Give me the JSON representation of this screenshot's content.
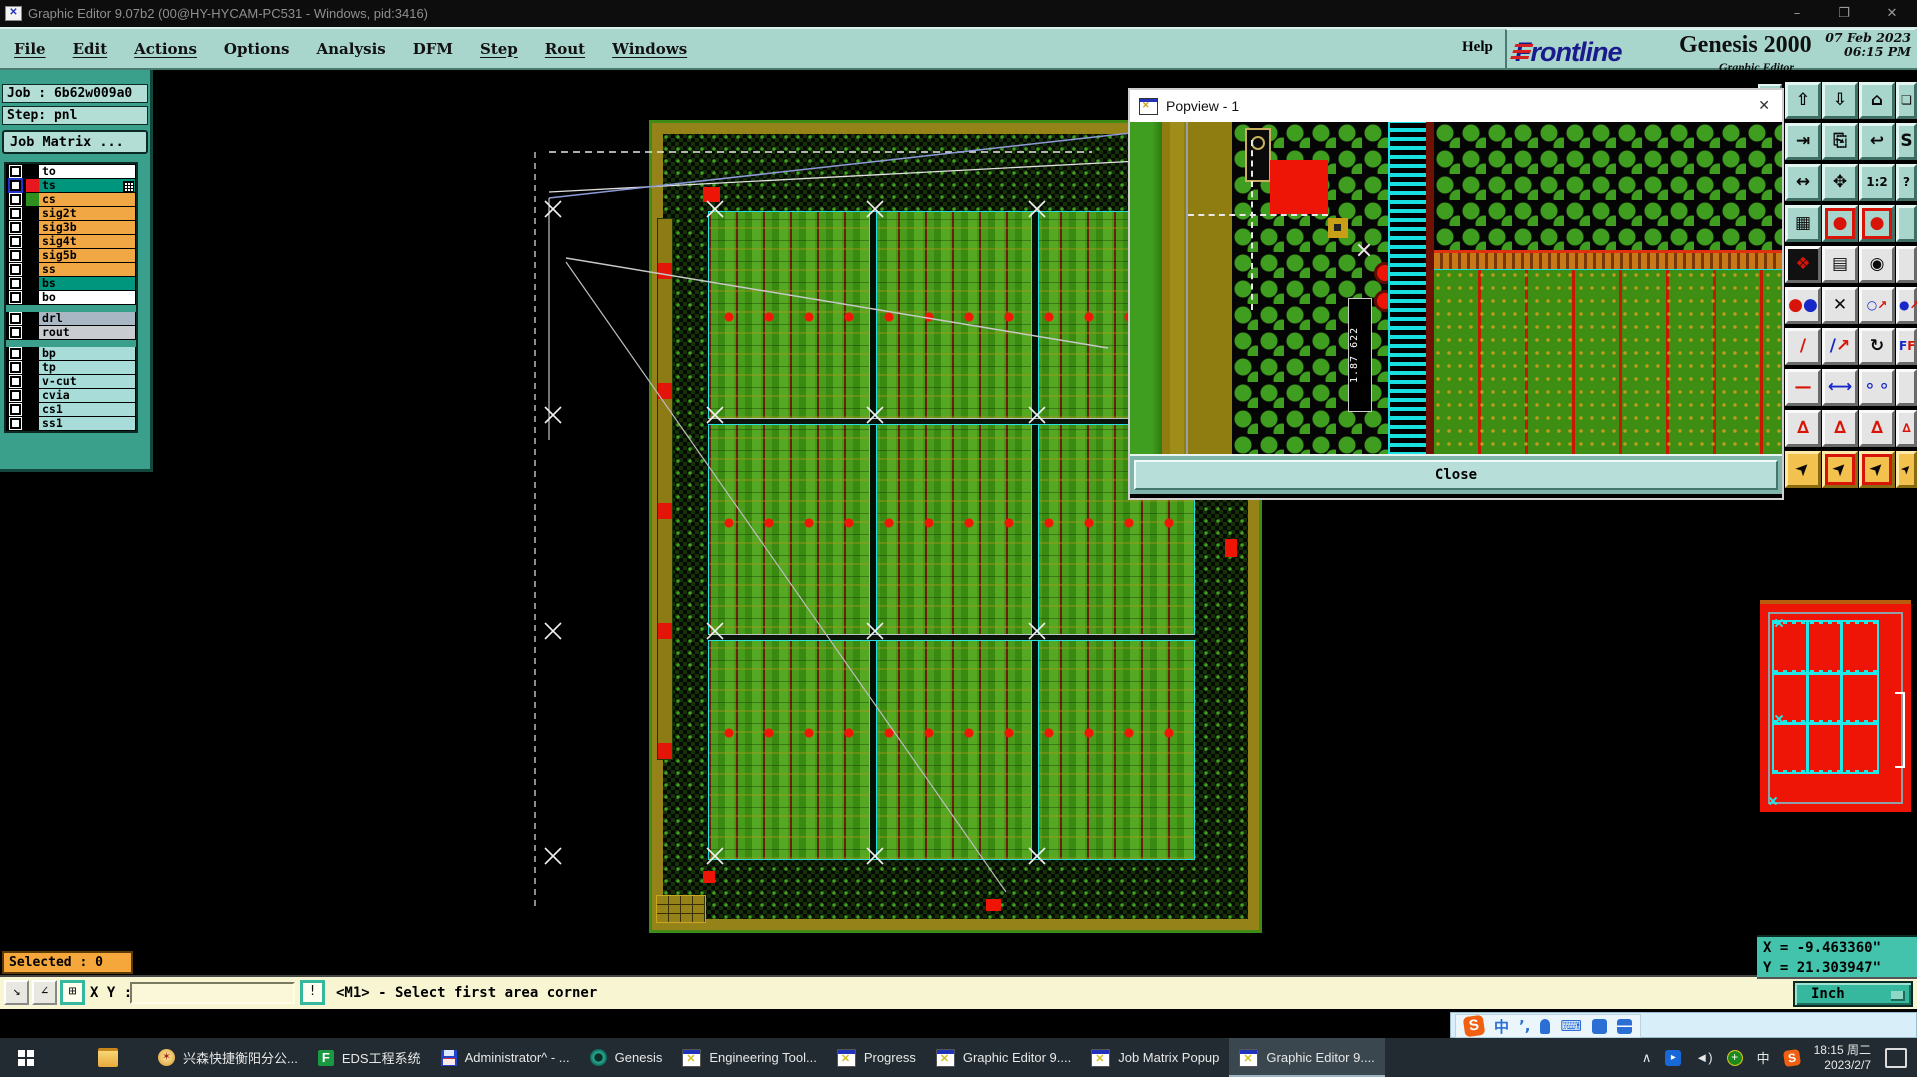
{
  "titlebar": {
    "title": "Graphic Editor 9.07b2 (00@HY-HYCAM-PC531 - Windows, pid:3416)",
    "minimize": "–",
    "maximize": "❐",
    "close": "✕"
  },
  "menubar": {
    "items": [
      "File",
      "Edit",
      "Actions",
      "Options",
      "Analysis",
      "DFM",
      "Step",
      "Rout",
      "Windows"
    ],
    "help": "Help"
  },
  "brand": {
    "logo": "Frontline",
    "product": "Genesis 2000",
    "edition": "Graphic Editor",
    "date": "07 Feb 2023",
    "time": "06:15 PM"
  },
  "job_panel": {
    "job": "Job : 6b62w009a0",
    "step": "Step: pnl",
    "matrix_button": "Job Matrix ..."
  },
  "layers": {
    "rows": [
      {
        "name": "to",
        "bg": "#ffffff",
        "swatch": "#000000"
      },
      {
        "name": "ts",
        "bg": "#00967d",
        "swatch": "#e8161d",
        "selected": true
      },
      {
        "name": "cs",
        "bg": "#f0a744",
        "swatch": "#2e8f1f"
      },
      {
        "name": "sig2t",
        "bg": "#f0a744",
        "swatch": "#000000"
      },
      {
        "name": "sig3b",
        "bg": "#f0a744",
        "swatch": "#000000"
      },
      {
        "name": "sig4t",
        "bg": "#f0a744",
        "swatch": "#000000"
      },
      {
        "name": "sig5b",
        "bg": "#f0a744",
        "swatch": "#000000"
      },
      {
        "name": "ss",
        "bg": "#f0a744",
        "swatch": "#000000"
      },
      {
        "name": "bs",
        "bg": "#00967d",
        "swatch": "#000000"
      },
      {
        "name": "bo",
        "bg": "#ffffff",
        "swatch": "#000000"
      },
      {
        "name": "drl",
        "bg": "#a9b7c4",
        "swatch": "#000000"
      },
      {
        "name": "rout",
        "bg": "#c9cdd1",
        "swatch": "#000000"
      },
      {
        "name": "bp",
        "bg": "#a8dcd8",
        "swatch": "#000000"
      },
      {
        "name": "tp",
        "bg": "#a8dcd8",
        "swatch": "#000000"
      },
      {
        "name": "v-cut",
        "bg": "#a8dcd8",
        "swatch": "#000000"
      },
      {
        "name": "cvia",
        "bg": "#a8dcd8",
        "swatch": "#000000"
      },
      {
        "name": "cs1",
        "bg": "#a8dcd8",
        "swatch": "#000000"
      },
      {
        "name": "ss1",
        "bg": "#a8dcd8",
        "swatch": "#000000"
      }
    ]
  },
  "popview": {
    "title": "Popview - 1",
    "close_x": "✕",
    "close_label": "Close",
    "ruler_label": "1.87 622"
  },
  "toolbar": {
    "glyphs": {
      "pan_up": "⇧",
      "screen_down": "⇩",
      "home": "⌂",
      "xy_window": "❏",
      "pan_right": "⇥",
      "screen_out": "⎘",
      "undo_view": "↩",
      "s_tool": "S",
      "fit_width": "↔",
      "pan_all": "✥",
      "ratio": "1:2",
      "help": "?",
      "grid": "▦",
      "highlight_a": "●",
      "highlight_b": "●",
      "measure_obj": "❖",
      "ruler": "▤",
      "spot": "◉",
      "dots": "∶",
      "delete": "✕",
      "copy_circle": "○↗",
      "copy_dot": "●↗",
      "slash": "/",
      "slash_arrow": "/",
      "rotate": "↻",
      "mirror": "F F",
      "dash1": "—",
      "dash2": "—",
      "resize": "⟷",
      "holes": "⚬⚬",
      "tri1": "∆",
      "tri2": "∆",
      "tri3": "∆",
      "tri4": "∆",
      "cursor1": "➤",
      "cursor2": "➤",
      "cursor3": "➤",
      "cursor4": "➤"
    }
  },
  "coord_readout": {
    "x": "X = -9.463360\"",
    "y": "Y = 21.303947\""
  },
  "statusbar": {
    "selected": "Selected : 0",
    "xy_label": "X Y :",
    "input_value": "",
    "bang": "!",
    "prompt": "<M1> - Select first area corner",
    "units": "Inch"
  },
  "ime_bar": {
    "s_logo": "S",
    "chinese": "中",
    "tone": "’,",
    "keyboard": "⌨"
  },
  "taskbar": {
    "apps": [
      {
        "label": "兴森快捷衡阳分公..."
      },
      {
        "label": "EDS工程系统"
      },
      {
        "label": "Administrator^ - ..."
      },
      {
        "label": "Genesis"
      },
      {
        "label": "Engineering Tool..."
      },
      {
        "label": "Progress"
      },
      {
        "label": "Graphic Editor 9...."
      },
      {
        "label": "Job Matrix Popup"
      },
      {
        "label": "Graphic Editor 9...."
      }
    ],
    "tray": {
      "chevron": "∧",
      "speaker": "◄)",
      "chinese": "中",
      "s": "S",
      "time": "18:15 周二",
      "date": "2023/2/7"
    }
  }
}
